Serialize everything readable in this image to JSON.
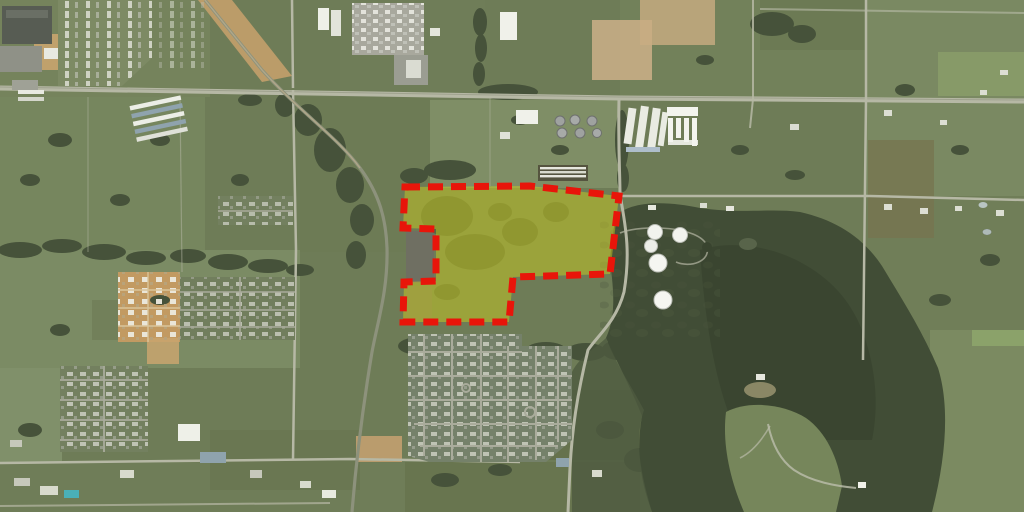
{
  "map": {
    "view_type": "satellite-aerial",
    "scene_description": "Aerial imagery of a semi-rural area: highway across the top, curving railroad, residential subdivisions to the south-west, a dark forested tract to the east, white storage tanks, and a highlighted land parcel",
    "width_px": 1024,
    "height_px": 512
  },
  "parcel_overlay": {
    "points": "405,187 530,186 619,196 610,274 513,277 509,322 403,322 404,282 436,281 436,229 403,228",
    "fill": "#d2d31b",
    "fill_opacity": "0.45",
    "stroke": "#e8150a",
    "stroke_width": "7",
    "stroke_dasharray": "15 8",
    "shape_note": "irregular polygon with L-shaped exclusion notch on west side"
  },
  "landmarks": {
    "tank_farm": {
      "name": "storage-tank-farm",
      "tanks": [
        {
          "x": 655,
          "y": 232,
          "r": 7.5
        },
        {
          "x": 680,
          "y": 235,
          "r": 7.5
        },
        {
          "x": 651,
          "y": 246,
          "r": 6.5
        },
        {
          "x": 658,
          "y": 263,
          "r": 9
        },
        {
          "x": 663,
          "y": 300,
          "r": 9
        }
      ]
    },
    "features": [
      "main-highway-east-west",
      "curving-railroad",
      "forest-tract-east",
      "subdivision-south-central",
      "subdivision-southwest",
      "construction-site-tan",
      "trailer-park-northwest",
      "poultry-houses",
      "industrial-yard-north",
      "rv-storage-rows",
      "white-warehouse-complex",
      "chicken-houses-north-of-parcel"
    ]
  },
  "colors": {
    "field_base": "#6e7c57",
    "forest": "#414d36",
    "road": "#b6b8a5",
    "dirt": "#c3a06c",
    "roof": "#bcbfb1",
    "parcel_fill": "#d2d31b",
    "parcel_stroke": "#e8150a"
  }
}
